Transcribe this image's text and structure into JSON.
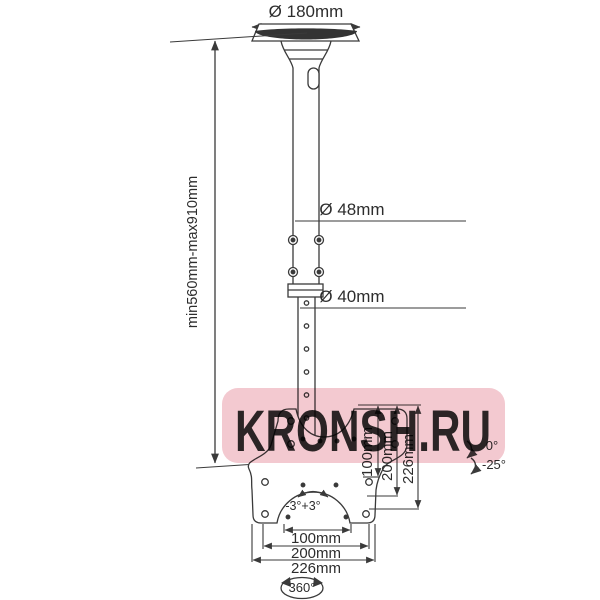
{
  "labels": {
    "ceiling_plate_diameter": "Ø 180mm",
    "upper_pole_diameter": "Ø 48mm",
    "lower_pole_diameter": "Ø 40mm",
    "height_range": "min560mm-max910mm",
    "tilt_max": "0°",
    "tilt_min": "-25°",
    "level_adjustment": "-3°+3°",
    "swivel": "360°"
  },
  "vertical_dimensions": [
    "100mm",
    "200mm",
    "226mm"
  ],
  "horizontal_dimensions": [
    "100mm",
    "200mm",
    "226mm"
  ],
  "watermark": {
    "text": "KRONSH.RU",
    "band_color": "#f3c9d0",
    "text_color": "#f9e4e8"
  },
  "colors": {
    "background": "#ffffff",
    "line": "#3a3a3a",
    "text": "#2d2d2d",
    "plate_rim": "#333333"
  }
}
